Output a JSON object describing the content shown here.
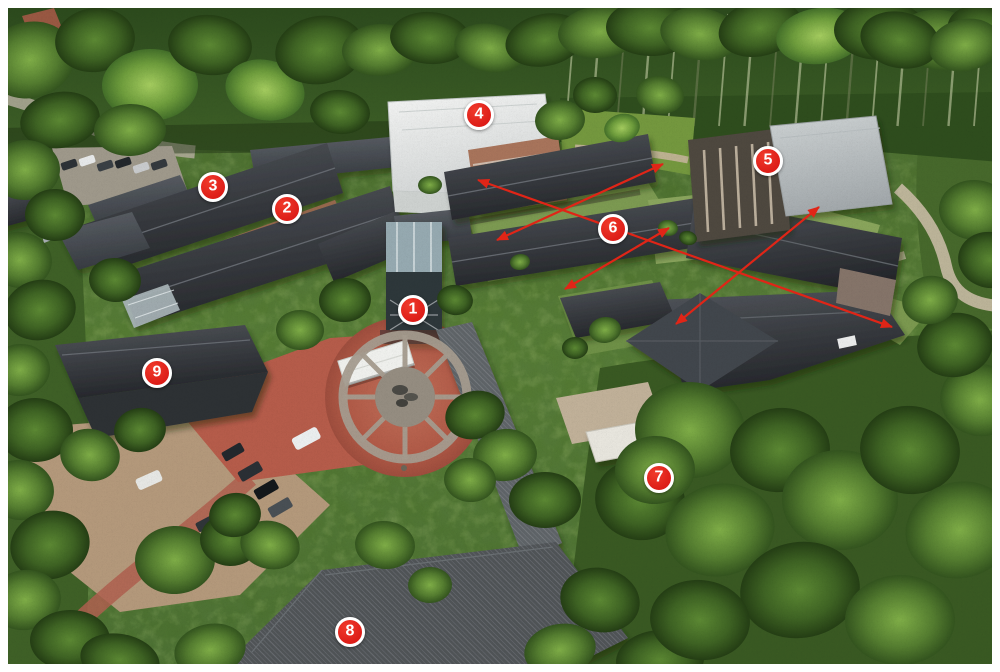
{
  "photo": {
    "border_color": "#ffffff"
  },
  "annotations": {
    "marker_fill": "#dd1d18",
    "marker_fill_light": "#f03a2b",
    "marker_ring": "#ffffff",
    "marker_text_color": "#ffffff",
    "arrow_color": "#e02517",
    "markers": [
      {
        "id": "1",
        "x": 413,
        "y": 310
      },
      {
        "id": "2",
        "x": 287,
        "y": 209
      },
      {
        "id": "3",
        "x": 213,
        "y": 187
      },
      {
        "id": "4",
        "x": 479,
        "y": 115
      },
      {
        "id": "5",
        "x": 768,
        "y": 161
      },
      {
        "id": "6",
        "x": 613,
        "y": 229
      },
      {
        "id": "7",
        "x": 659,
        "y": 478
      },
      {
        "id": "8",
        "x": 350,
        "y": 632
      },
      {
        "id": "9",
        "x": 157,
        "y": 373
      }
    ],
    "arrows": [
      {
        "x1": 478,
        "y1": 180,
        "x2": 892,
        "y2": 327,
        "heads": "both"
      },
      {
        "x1": 663,
        "y1": 164,
        "x2": 497,
        "y2": 240,
        "heads": "both"
      },
      {
        "x1": 669,
        "y1": 228,
        "x2": 565,
        "y2": 289,
        "heads": "both"
      },
      {
        "x1": 819,
        "y1": 207,
        "x2": 676,
        "y2": 324,
        "heads": "both"
      }
    ]
  }
}
